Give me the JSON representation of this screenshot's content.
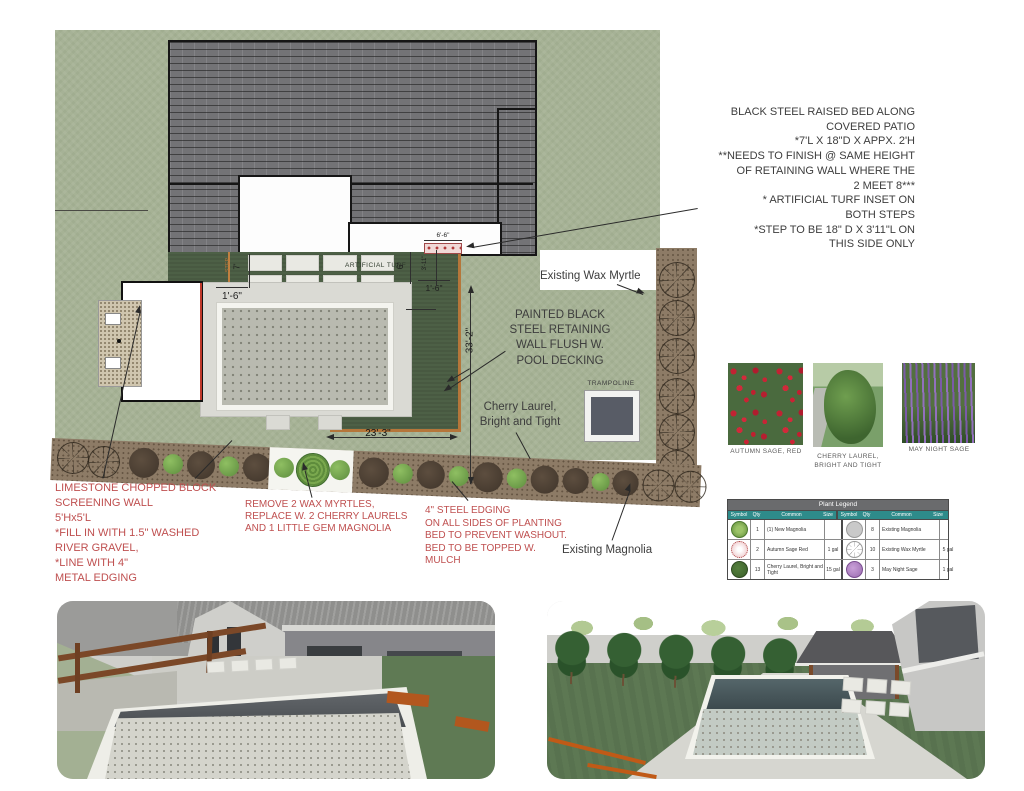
{
  "notes": {
    "raised_bed": "BLACK STEEL RAISED BED ALONG\nCOVERED PATIO\n*7'L X 18\"D X APPX. 2'H\n**NEEDS TO FINISH @ SAME HEIGHT\nOF RETAINING WALL WHERE THE\n2 MEET 8***\n* ARTIFICIAL TURF INSET ON\nBOTH STEPS\n*STEP TO BE 18\" D X 3'11\"L ON\nTHIS SIDE ONLY",
    "painted_wall": "PAINTED BLACK\nSTEEL RETAINING\nWALL FLUSH W.\nPOOL DECKING",
    "limestone": "LIMESTONE CHOPPED BLOCK\nSCREENING WALL\n5'Hx5'L\n*FILL IN WITH 1.5\" WASHED\nRIVER GRAVEL,\n*LINE WITH 4\"\nMETAL EDGING",
    "remove_myrtles": "REMOVE 2 WAX MYRTLES,\nREPLACE W. 2 CHERRY LAURELS\nAND 1 LITTLE GEM MAGNOLIA",
    "steel_edging": "4\" STEEL EDGING\nON ALL SIDES OF PLANTING\nBED TO PREVENT WASHOUT.\nBED TO BE TOPPED W.\nMULCH"
  },
  "labels": {
    "existing_wax_myrtle": "Existing Wax Myrtle",
    "cherry_laurel": "Cherry Laurel,\nBright and Tight",
    "existing_magnolia": "Existing Magnolia",
    "trampoline": "TRAMPOLINE",
    "artificial_turf": "ARTIFICIAL TURF",
    "step": "STEP"
  },
  "dims": {
    "left_gap": "1'-6\"",
    "step_width": "7'",
    "right_gap": "1'-6\"",
    "turf_depth": "6'",
    "step_length": "3'-11\"",
    "bed_length": "6'-6\"",
    "yard_depth": "33'-2\"",
    "pool_length": "23'-3\""
  },
  "photos": [
    {
      "caption": "AUTUMN SAGE, RED"
    },
    {
      "caption": "CHERRY LAUREL,\nBRIGHT AND TIGHT"
    },
    {
      "caption": "MAY NIGHT SAGE"
    }
  ],
  "legend": {
    "title": "Plant Legend",
    "headers": [
      "Symbol",
      "Qty",
      "Common",
      "Size"
    ],
    "rows": [
      {
        "left": {
          "qty": "1",
          "name": "(1) New Magnolia",
          "size": ""
        },
        "right": {
          "qty": "8",
          "name": "Existing Magnolia",
          "size": ""
        }
      },
      {
        "left": {
          "qty": "2",
          "name": "Autumn Sage Red",
          "size": "1 gal"
        },
        "right": {
          "qty": "10",
          "name": "Existing Wax Myrtle",
          "size": "5 gal"
        }
      },
      {
        "left": {
          "qty": "13",
          "name": "Cherry Laurel, Bright and Tight",
          "size": "15 gal"
        },
        "right": {
          "qty": "3",
          "name": "May Night Sage",
          "size": "1 gal"
        }
      }
    ]
  },
  "colors": {
    "lawn": "#a6b295",
    "turf": "#4d6046",
    "roof": "#737376",
    "mulch": "#8d7b66",
    "red_note": "#bf4f4f",
    "ink": "#3d3d3d",
    "legend_header": "#2e8b8a",
    "legend_title_bar": "#6a6b6d",
    "retaining_wall": "#b5763a"
  }
}
